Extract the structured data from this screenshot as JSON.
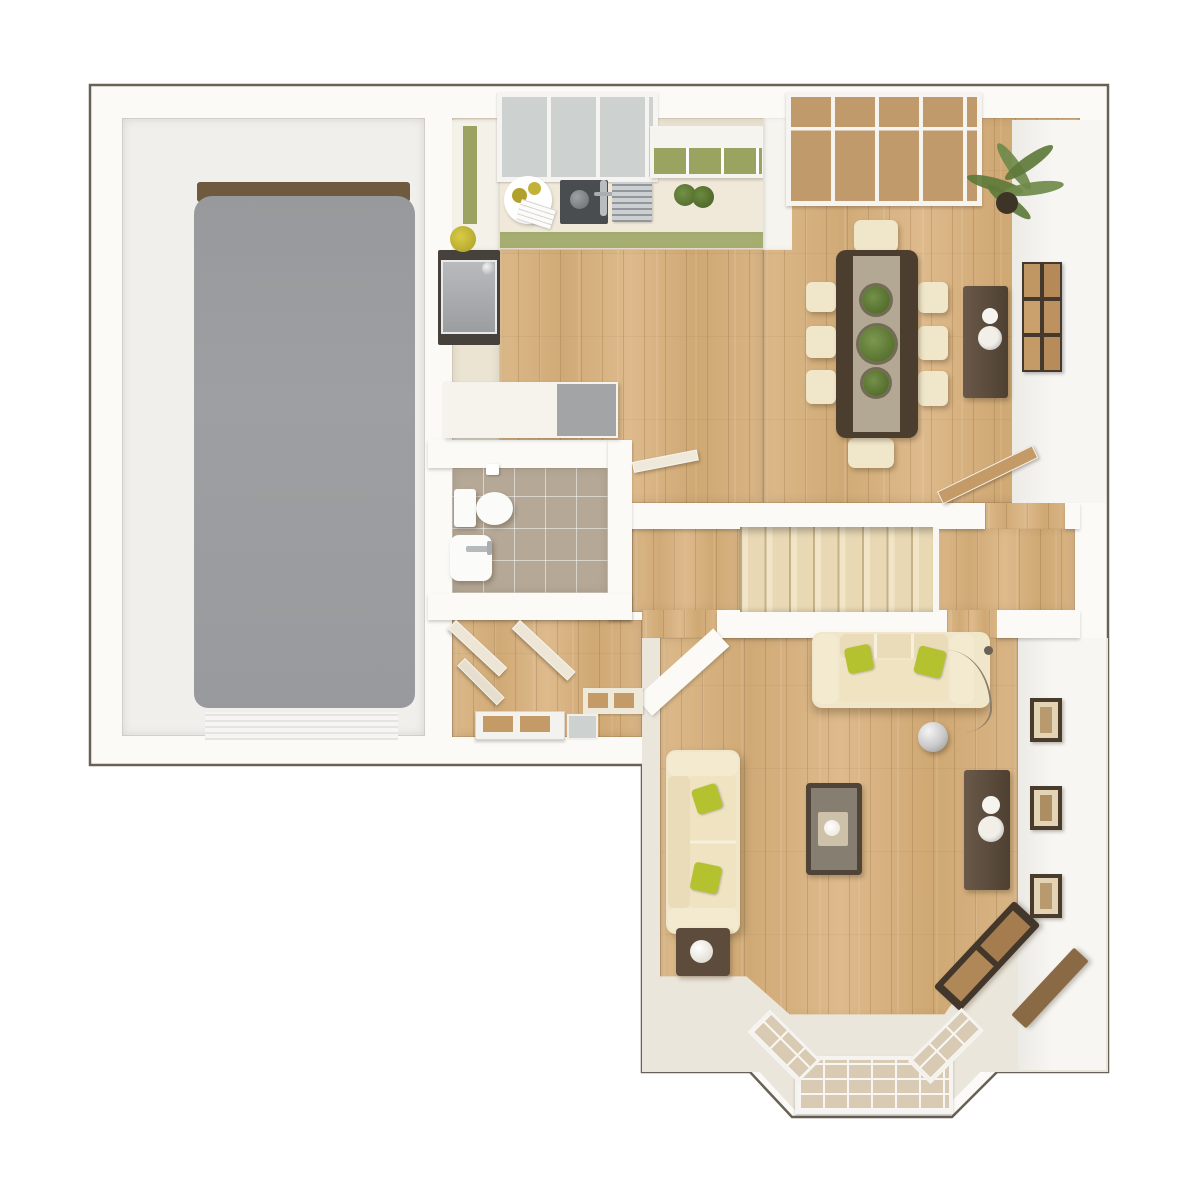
{
  "plan": {
    "type": "3d-top-down-floor-plan",
    "storey": "ground-floor",
    "rooms": [
      "garage",
      "kitchen",
      "dining-area",
      "wc",
      "entrance-hall",
      "staircase",
      "rear-hall",
      "living-room",
      "bay-window"
    ]
  },
  "palette": {
    "page_bg": "#ffffff",
    "wall_fill": "#fbfaf7",
    "wall_outline": "#6a6156",
    "wood_base": "#d8b383",
    "kitchen_floor": "#ece4d3",
    "garage_floor": "#f0efec",
    "garage_pad": "#9b9da0",
    "garage_shadow": "#6f5a40",
    "stairs_carpet": "#ecdcba",
    "tile_floor": "#b5a896",
    "sofa_cream": "#f0e6c9",
    "sofa_seat": "#eadcb9",
    "pillow_green": "#b5c22f",
    "table_dark": "#4b3e2f",
    "runner_taupe": "#b2a894",
    "console_brown": "#5d4c3c",
    "frame_brown": "#4a3c2d",
    "art_tan": "#c09663",
    "glass_gray": "#cdd1d0",
    "glass_tan": "#c09a6a",
    "bay_glass": "#d9cbb3",
    "counter_cream": "#f0e9da",
    "cabinet_green": "#9aa35f",
    "appliance_gray": "#a2a4a6",
    "appliance_dark": "#46413b",
    "plant_green": "#5e7a39",
    "door_wood": "#c49b66",
    "fixture_white": "#fbfbfa",
    "living_cream": "#ebe6db",
    "lamp_silver": "#c9c9c9"
  },
  "furniture": {
    "garage": [
      "floor-pad",
      "roller-garage-door"
    ],
    "kitchen": [
      "window",
      "worktop",
      "breakfast-tray",
      "hob",
      "sink-faucet",
      "drainer-rack",
      "herb-pots",
      2,
      "oven",
      "kettle",
      "flower-vase",
      "wall-cabinets",
      "peninsula-unit",
      "dishwasher"
    ],
    "dining": {
      "chairs": 8,
      "items": [
        "french-doors",
        "dining-table",
        "table-runner",
        "plant-bowls-x3",
        "sideboard",
        "vases-x2",
        "wall-art-grid-x6",
        "palm-plant",
        "door-leaf"
      ]
    },
    "wc": [
      "toilet",
      "cistern",
      "toilet-roll",
      "basin",
      "tap"
    ],
    "entrance": [
      "door-leaves-x3",
      "shoe-cabinet",
      "front-door",
      "sidelight"
    ],
    "staircase": {
      "treads": 8,
      "items": [
        "carpet-runner",
        "landing"
      ]
    },
    "living_room": [
      "sofa-3-seat",
      "sofa-2-seat",
      "green-cushions-x4",
      "coffee-table",
      "tray-and-cup",
      "side-table",
      "table-lamp",
      "media-console",
      "vases-x2",
      "arc-floor-lamp",
      "corner-console",
      "picture-frames-x3",
      "bay-window-glazing-x3"
    ]
  }
}
